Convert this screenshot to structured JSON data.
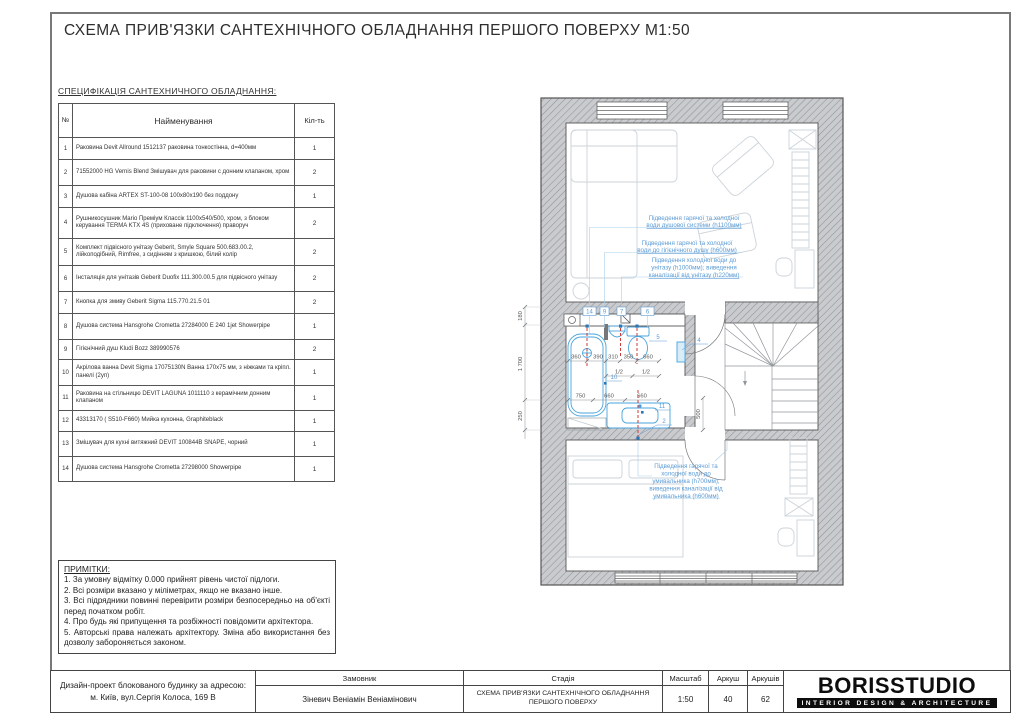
{
  "sheet": {
    "title": "СХЕМА ПРИВ'ЯЗКИ САНТЕХНІЧНОГО ОБЛАДНАННЯ ПЕРШОГО ПОВЕРХУ М1:50"
  },
  "spec_table": {
    "title": "СПЕЦИФІКАЦІЯ САНТЕХНИЧНОГО ОБЛАДНАННЯ:",
    "headers": {
      "num": "№",
      "name": "Найменування",
      "qty": "Кіл-ть"
    },
    "rows": [
      {
        "num": "1",
        "name": "Раковина Devit Allround 1512137 раковина тонкостінна, d=400мм",
        "qty": "1"
      },
      {
        "num": "2",
        "name": "71552000 HG Vernis Blend Змішувач для раковини с донним клапаном, хром",
        "qty": "2"
      },
      {
        "num": "3",
        "name": "Душова кабіна ARTEX ST-100-08 100х80х190 без поддону",
        "qty": "1"
      },
      {
        "num": "4",
        "name": "Рушникосушник Mario Преміум Классік 1100х540/500, хром, з блоком керування TERMA KTX 4S (приховане підключення) праворуч",
        "qty": "2"
      },
      {
        "num": "5",
        "name": "Комплект підвісного унітазу Geberit, Smyle Square 500.683.00.2, лійкоподібний, Rimfree, з сидінням з кришкою, білий колір",
        "qty": "2"
      },
      {
        "num": "6",
        "name": "Інсталяція для унітазів Geberit Duofix 111.300.00.5 для підвісного унітазу",
        "qty": "2"
      },
      {
        "num": "7",
        "name": "Кнопка для змиву Geberit Sigma 115.770.21.5 01",
        "qty": "2"
      },
      {
        "num": "8",
        "name": "Душова система Hansgrohe Crometta 27284000 E 240 1jet Showerpipe",
        "qty": "1"
      },
      {
        "num": "9",
        "name": "Гігієнічний душ Kludi Bozz 389990576",
        "qty": "2"
      },
      {
        "num": "10",
        "name": "Акрілова ванна Devit Sigma 17075130N Ванна 170х75 мм, з ніжками та кріпл. панелі (2уп)",
        "qty": "1"
      },
      {
        "num": "11",
        "name": "Раковина на стільницю DEVIT LAGUNA 1011110 з керамічним донним клапаном",
        "qty": "1"
      },
      {
        "num": "12",
        "name": "43313170 ( S510-F660) Мийка кухонна, Graphiteblack",
        "qty": "1"
      },
      {
        "num": "13",
        "name": "Змішувач для кухні витяжний DEVIT 100844B SNAPE, чорний",
        "qty": "1"
      },
      {
        "num": "14",
        "name": "Душова система Hansgrohe Crometta 27298000 Showerpipe",
        "qty": "1"
      }
    ]
  },
  "notes": {
    "title": "ПРИМІТКИ:",
    "items": [
      "1. За умовну відмітку 0.000 прийнят рівень чистої підлоги.",
      "2. Всі розміри вказано у міліметрах, якщо не вказано інше.",
      "3. Всі підрядники повинні перевірити розміри безпосередньо на об'єкті перед початком робіт.",
      "4. Про будь які припущення та розбіжності повідомити архітектора.",
      "5. Авторські права належать архітектору. Зміна або використання без дозволу забороняється законом."
    ]
  },
  "plan": {
    "annotations": [
      {
        "lines": [
          "Підведення гарячої та холодної",
          "води душової системи (h1100мм)"
        ]
      },
      {
        "lines": [
          "Підведення гарячої та холодної",
          "води до гігієнічного душу (h600мм)"
        ]
      },
      {
        "lines": [
          "Підведення холодної води до",
          "унітазу (h1000мм); виведення",
          "каналізації від унітазу (h220мм)"
        ]
      },
      {
        "lines": [
          "Підведення гарячої та",
          "холодної води до",
          "умивальника (h700мм);",
          "виведення каналізації від",
          "умивальника (h600мм)"
        ]
      }
    ],
    "tags": [
      "14",
      "9",
      "7",
      "6",
      "5",
      "4",
      "10",
      "11",
      "2"
    ],
    "dims": {
      "row1": [
        "360",
        "390",
        "310",
        "350",
        "660"
      ],
      "row2": [
        "1/2",
        "1/2"
      ],
      "row3": [
        "750",
        "660",
        "660"
      ],
      "left": [
        "180",
        "1 700",
        "250"
      ],
      "hall": "500"
    }
  },
  "titleblock": {
    "project": "Дизайн-проект блокованого будинку за адресою: м. Київ, вул.Сергія Колоса, 169 В",
    "customer_label": "Замовник",
    "customer": "Зіневич Веніамін Веніамінович",
    "stage_label": "Стадія",
    "stage": "СХЕМА ПРИВ'ЯЗКИ САНТЕХНІЧНОГО ОБЛАДНАННЯ ПЕРШОГО ПОВЕРХУ",
    "scale_label": "Масштаб",
    "scale": "1:50",
    "sheet_label": "Аркуш",
    "sheet": "40",
    "sheets_label": "Аркушів",
    "sheets": "62",
    "logo": "BORISSTUDIO",
    "logo_sub": "INTERIOR DESIGN & ARCHITECTURE"
  },
  "colors": {
    "annotation_blue": "#5b9bd5",
    "fixture_blue": "#4aa3dc",
    "plumbing_red": "#cf3a3a",
    "wall_gray": "#c9cbce"
  }
}
